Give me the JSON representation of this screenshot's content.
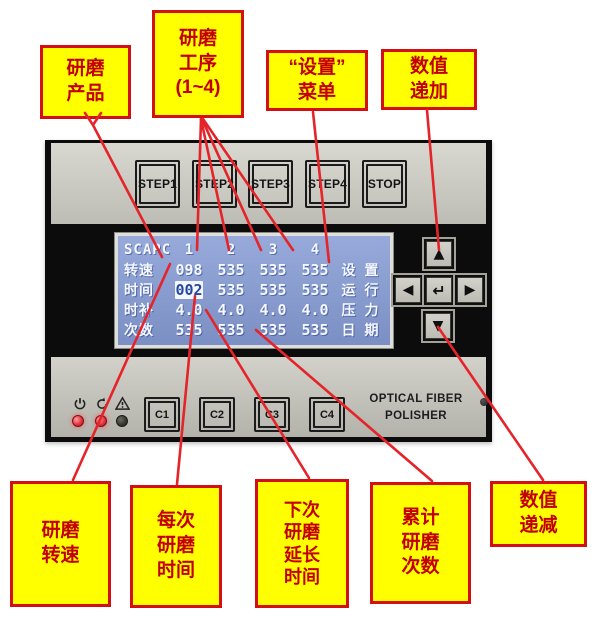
{
  "callouts": {
    "product": {
      "text": "研磨\n产品"
    },
    "step": {
      "text": "研磨\n工序\n(1~4)"
    },
    "menu": {
      "text": "“设置”\n菜单"
    },
    "increase": {
      "text": "数值\n递加"
    },
    "speed": {
      "text": "研磨\n转速"
    },
    "time": {
      "text": "每次\n研磨\n时间"
    },
    "next": {
      "text": "下次\n研磨\n延长\n时间"
    },
    "count": {
      "text": "累计\n研磨\n次数"
    },
    "decrease": {
      "text": "数值\n递减"
    }
  },
  "device": {
    "step_buttons": {
      "b1": "STEP1",
      "b2": "STEP2",
      "b3": "STEP3",
      "b4": "STEP4",
      "stop": "STOP"
    },
    "c_buttons": {
      "c1": "C1",
      "c2": "C2",
      "c3": "C3",
      "c4": "C4"
    },
    "keypad": {
      "up": "▲",
      "left": "◀",
      "enter": "↵",
      "right": "▶",
      "down": "▼"
    },
    "brand": {
      "line1": "OPTICAL FIBER",
      "line2": "POLISHER"
    },
    "lcd": {
      "product": "SCAPC",
      "columns": {
        "c1": "1",
        "c2": "2",
        "c3": "3",
        "c4": "4"
      },
      "rows": {
        "speed": {
          "label": "转速",
          "v1": "098",
          "v2": "535",
          "v3": "535",
          "v4": "535"
        },
        "time": {
          "label": "时间",
          "v1": "002",
          "v2": "535",
          "v3": "535",
          "v4": "535"
        },
        "extend": {
          "label": "时补",
          "v1": "4.0",
          "v2": "4.0",
          "v3": "4.0",
          "v4": "4.0"
        },
        "count": {
          "label": "次数",
          "v1": "535",
          "v2": "535",
          "v3": "535",
          "v4": "535"
        }
      },
      "menu": {
        "m1a": "设",
        "m1b": "置",
        "m2a": "运",
        "m2b": "行",
        "m3a": "压",
        "m3b": "力",
        "m4a": "日",
        "m4b": "期"
      }
    }
  },
  "colors": {
    "callout_bg": "#ffff00",
    "callout_border": "#d40f0f",
    "callout_text": "#c30000",
    "annotation_line": "#e5242a",
    "lcd_bg": "#8497cb",
    "lcd_text": "#f5f8ff"
  }
}
